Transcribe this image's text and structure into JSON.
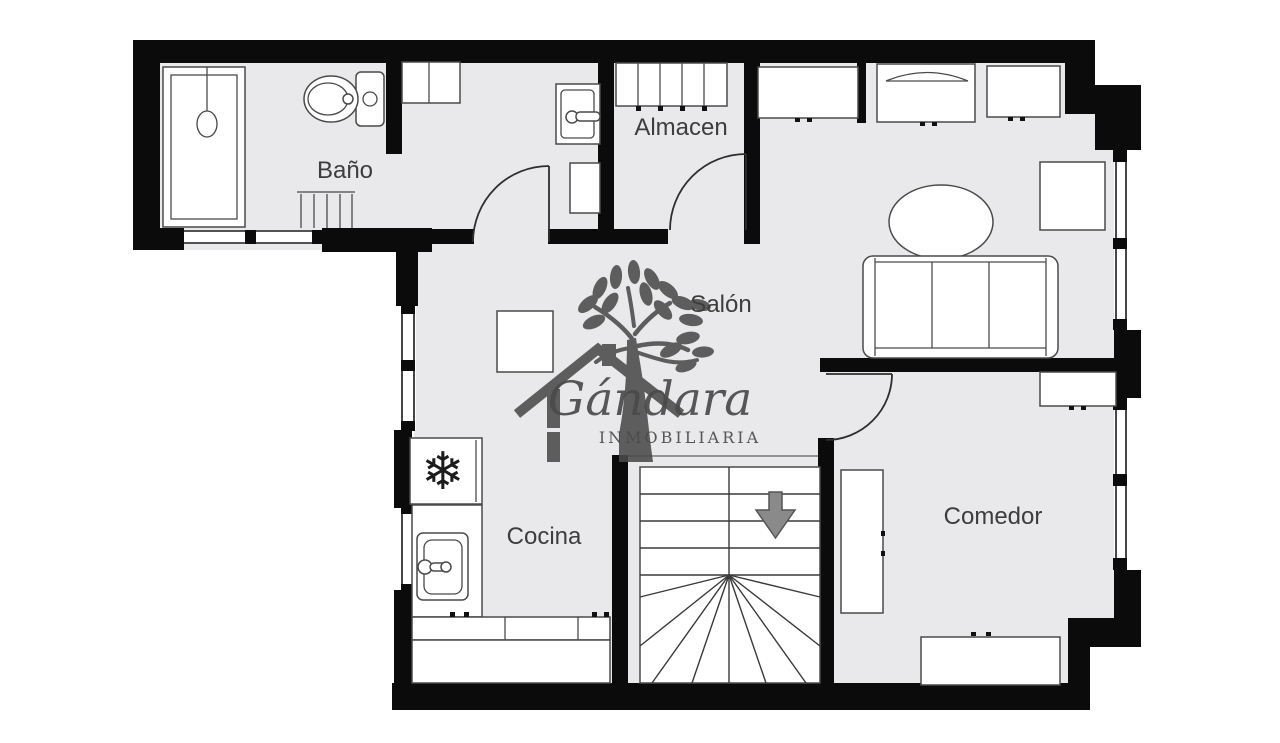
{
  "plan": {
    "rooms": {
      "bathroom": {
        "label": "Baño"
      },
      "storage": {
        "label": "Almacen"
      },
      "living_room": {
        "label": "Salón"
      },
      "kitchen": {
        "label": "Cocina"
      },
      "dining_room": {
        "label": "Comedor"
      }
    },
    "stairs": {
      "direction_icon": "down-arrow"
    },
    "icons": {
      "fridge_snowflake": "❄"
    }
  },
  "watermark": {
    "brand": "Gándara",
    "subtitle": "INMOBILIARIA"
  },
  "colors": {
    "background": "#ffffff",
    "floor": "#e9e9eb",
    "wall": "#0b0b0b",
    "furniture_line": "#4a4a4a",
    "label_text": "#3d3d3d",
    "watermark": "#4a4a4a",
    "arrow_fill": "#8a8a8a"
  }
}
